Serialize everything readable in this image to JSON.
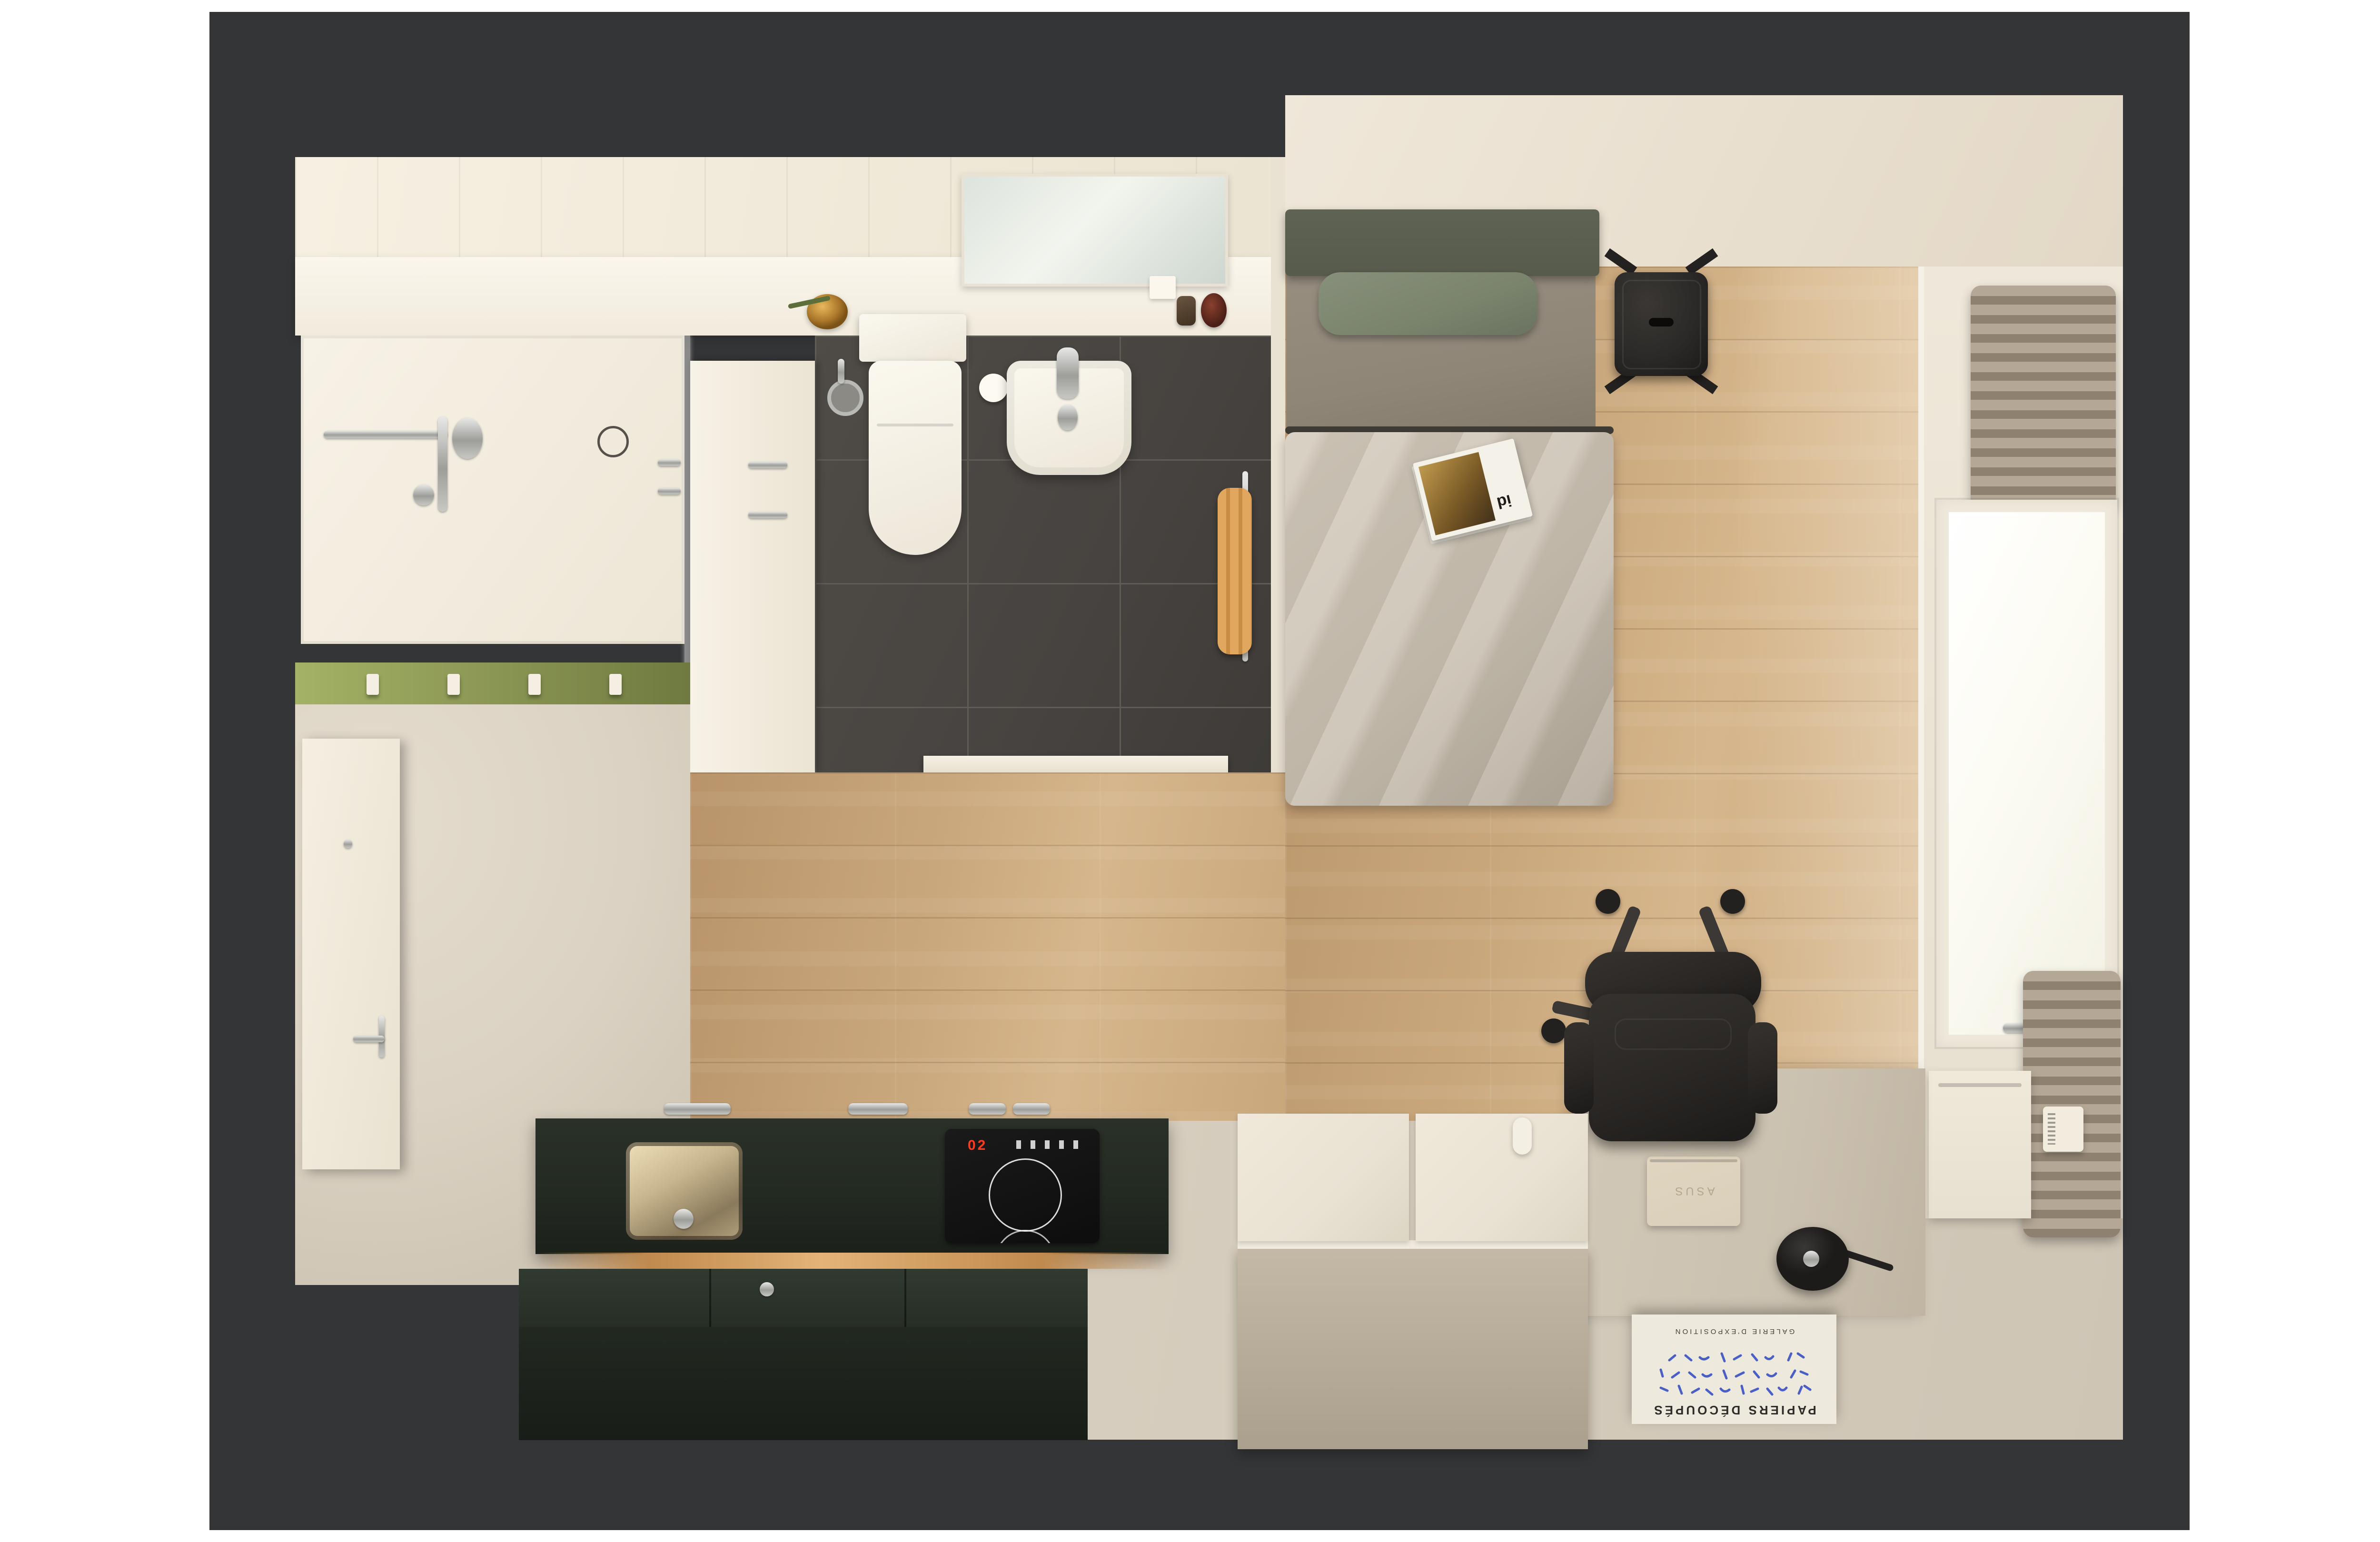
{
  "scene": {
    "title": "Top-down 3D render of a studio apartment",
    "rooms": [
      {
        "name": "bathroom",
        "features": [
          "shower",
          "glass-partition",
          "toilet",
          "wall-sink",
          "vanity-mirror",
          "towel-rail",
          "storage-cabinet",
          "dark-tile-floor"
        ]
      },
      {
        "name": "entry",
        "features": [
          "entrance-door",
          "olive-coat-rack-wall",
          "coat-hooks"
        ]
      },
      {
        "name": "kitchen",
        "features": [
          "dark-green-cabinets",
          "stainless-sink",
          "induction-hob",
          "island",
          "under-cabinet-light"
        ]
      },
      {
        "name": "living-bedroom",
        "features": [
          "double-bed",
          "green-pillow",
          "magazine",
          "metal-stool",
          "window-with-curtains",
          "radiator",
          "desk",
          "laptop",
          "desk-lamp",
          "office-chair",
          "storage-bench",
          "art-print"
        ]
      }
    ]
  },
  "poster": {
    "title": "PAPIERS DÉCOUPÉS",
    "subtitle": "GALERIE D'EXPOSITION"
  },
  "laptop": {
    "logo": "ASUS"
  },
  "magazine": {
    "cover_label": "id"
  },
  "hob": {
    "display": "02"
  },
  "palette": {
    "structure": "#343537",
    "cream-wall": "#efe7d9",
    "cream-wall-deep": "#e3d8c6",
    "bath-floor-dark": "#474340",
    "bath-grout": "#5f5b55",
    "glass-tint": "rgba(244,245,240,0.45)",
    "towel-orange": "#e2a75f",
    "wood": "#c9a77c",
    "wood-dark": "#b9946a",
    "wood-light": "#d6b68c",
    "beige-floor": "#dbd2c3",
    "beige-floor-2": "#cfc5b5",
    "olive-wall": "#8d9955",
    "kitchen-dark": "#232a22",
    "glow": "#c08a4e",
    "hob-red": "#ff3b1f",
    "headboard": "#565b4c",
    "pillow": "#7a836c",
    "mattress": "#8f8678",
    "duvet": "#c9c0b1",
    "stool-black": "#2b2927",
    "chair-black": "#2a2725",
    "desk-tan": "#cbc1b0",
    "laptop-tan": "#d9cfba",
    "bench-top": "#e9e2d3",
    "bench-front": "#b5aa99",
    "poster-bg": "#ede9dc",
    "poster-blue": "#4a5fc5",
    "window-glass": "#fcfbf3",
    "window-frame": "#efe9dc",
    "curtain": "#b4a795",
    "curtain-dark": "#8e8170",
    "radiator": "#e7e0d1"
  }
}
